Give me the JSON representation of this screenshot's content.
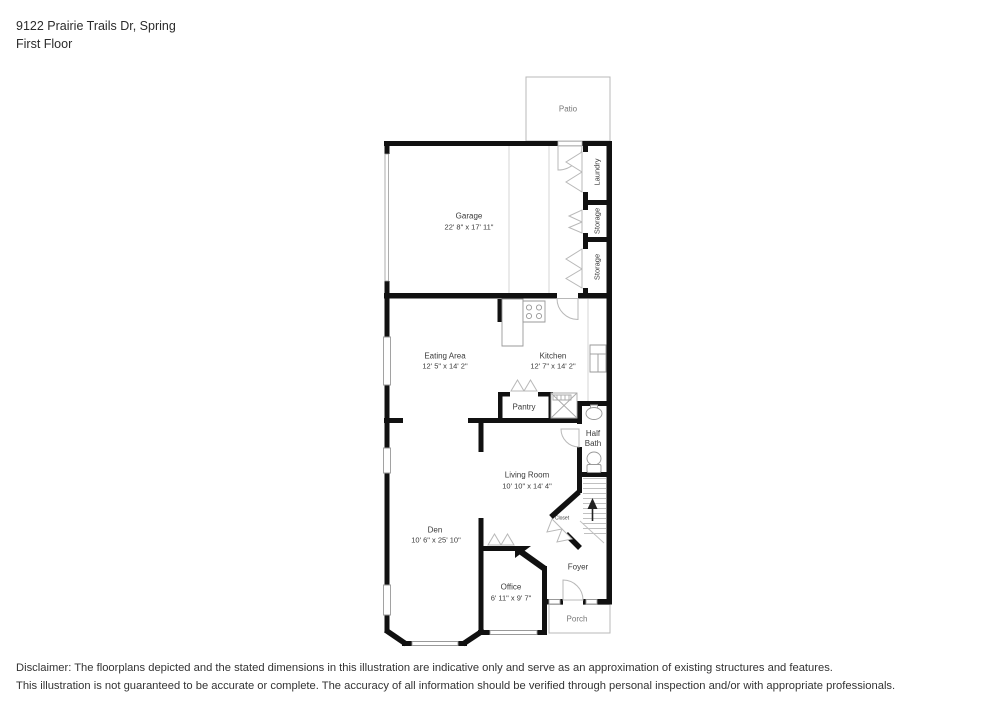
{
  "header": {
    "address": "9122 Prairie Trails Dr, Spring",
    "floor_label": "First Floor"
  },
  "rooms": {
    "patio": {
      "name": "Patio"
    },
    "garage": {
      "name": "Garage",
      "dims": "22' 8\" x 17' 11\""
    },
    "laundry": {
      "name": "Laundry"
    },
    "storage_upper": {
      "name": "Storage"
    },
    "storage_lower": {
      "name": "Storage"
    },
    "eating_area": {
      "name": "Eating Area",
      "dims": "12' 5\" x 14' 2\""
    },
    "kitchen": {
      "name": "Kitchen",
      "dims": "12' 7\" x 14' 2\""
    },
    "pantry": {
      "name": "Pantry"
    },
    "half_bath": {
      "name": "Half Bath"
    },
    "living_room": {
      "name": "Living Room",
      "dims": "10' 10\" x 14' 4\""
    },
    "closet": {
      "name": "Closet"
    },
    "den": {
      "name": "Den",
      "dims": "10' 6\" x 25' 10\""
    },
    "office": {
      "name": "Office",
      "dims": "6' 11\" x 9' 7\""
    },
    "foyer": {
      "name": "Foyer"
    },
    "porch": {
      "name": "Porch"
    }
  },
  "disclaimer": {
    "line1": "Disclaimer: The floorplans depicted and the stated dimensions in this illustration are indicative only and serve as an approximation of existing structures and features.",
    "line2": "This illustration is not guaranteed to be accurate or complete. The accuracy of all information should be verified through personal inspection and/or with appropriate professionals."
  },
  "colors": {
    "wall": "#111111",
    "door_symbol": "#b8b8b8",
    "fixture": "#999999",
    "text": "#3a3a3a"
  }
}
